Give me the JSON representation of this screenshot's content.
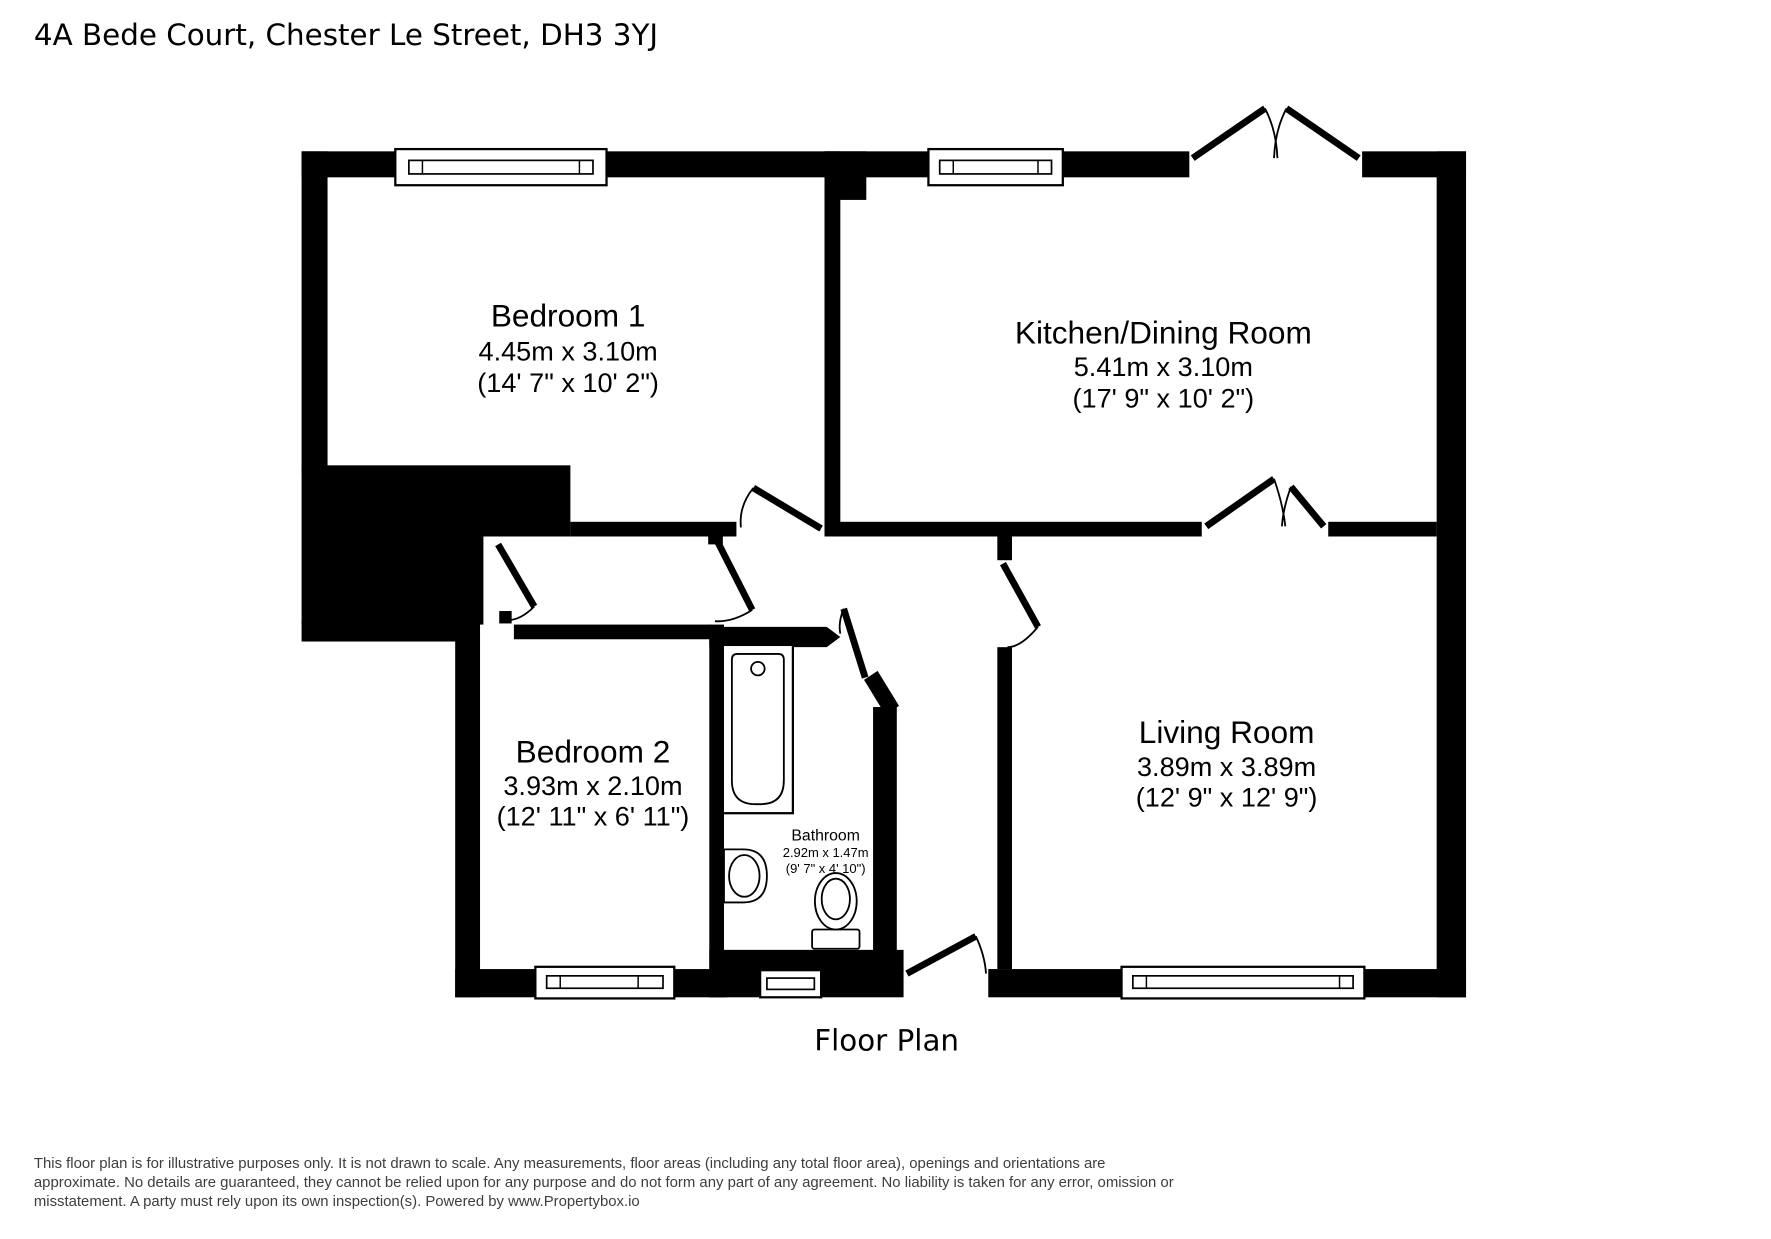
{
  "title": "4A Bede Court, Chester Le Street, DH3 3YJ",
  "caption": "Floor Plan",
  "rooms": {
    "bedroom1": {
      "name": "Bedroom 1",
      "metric": "4.45m x 3.10m",
      "imperial": "(14' 7\" x 10' 2\")"
    },
    "kitchen": {
      "name": "Kitchen/Dining Room",
      "metric": "5.41m x 3.10m",
      "imperial": "(17' 9\" x 10' 2\")"
    },
    "bedroom2": {
      "name": "Bedroom 2",
      "metric": "3.93m x 2.10m",
      "imperial": "(12' 11\" x 6' 11\")"
    },
    "bathroom": {
      "name": "Bathroom",
      "metric": "2.92m x 1.47m",
      "imperial": "(9' 7\" x 4' 10\")"
    },
    "living": {
      "name": "Living Room",
      "metric": "3.89m x 3.89m",
      "imperial": "(12' 9\" x 12' 9\")"
    }
  },
  "disclaimer": {
    "line1": "This floor plan is for illustrative purposes only. It is not drawn to scale. Any measurements, floor areas (including any total floor area), openings and orientations are",
    "line2": "approximate. No details are guaranteed, they cannot be relied upon for any purpose and do not form any part of any agreement. No liability is taken for any error, omission or",
    "line3": "misstatement. A party must rely upon its own inspection(s). Powered by www.Propertybox.io"
  },
  "colors": {
    "wall": "#000000",
    "background": "#ffffff",
    "text": "#000000",
    "disclaimer_text": "#3e3e3e"
  }
}
